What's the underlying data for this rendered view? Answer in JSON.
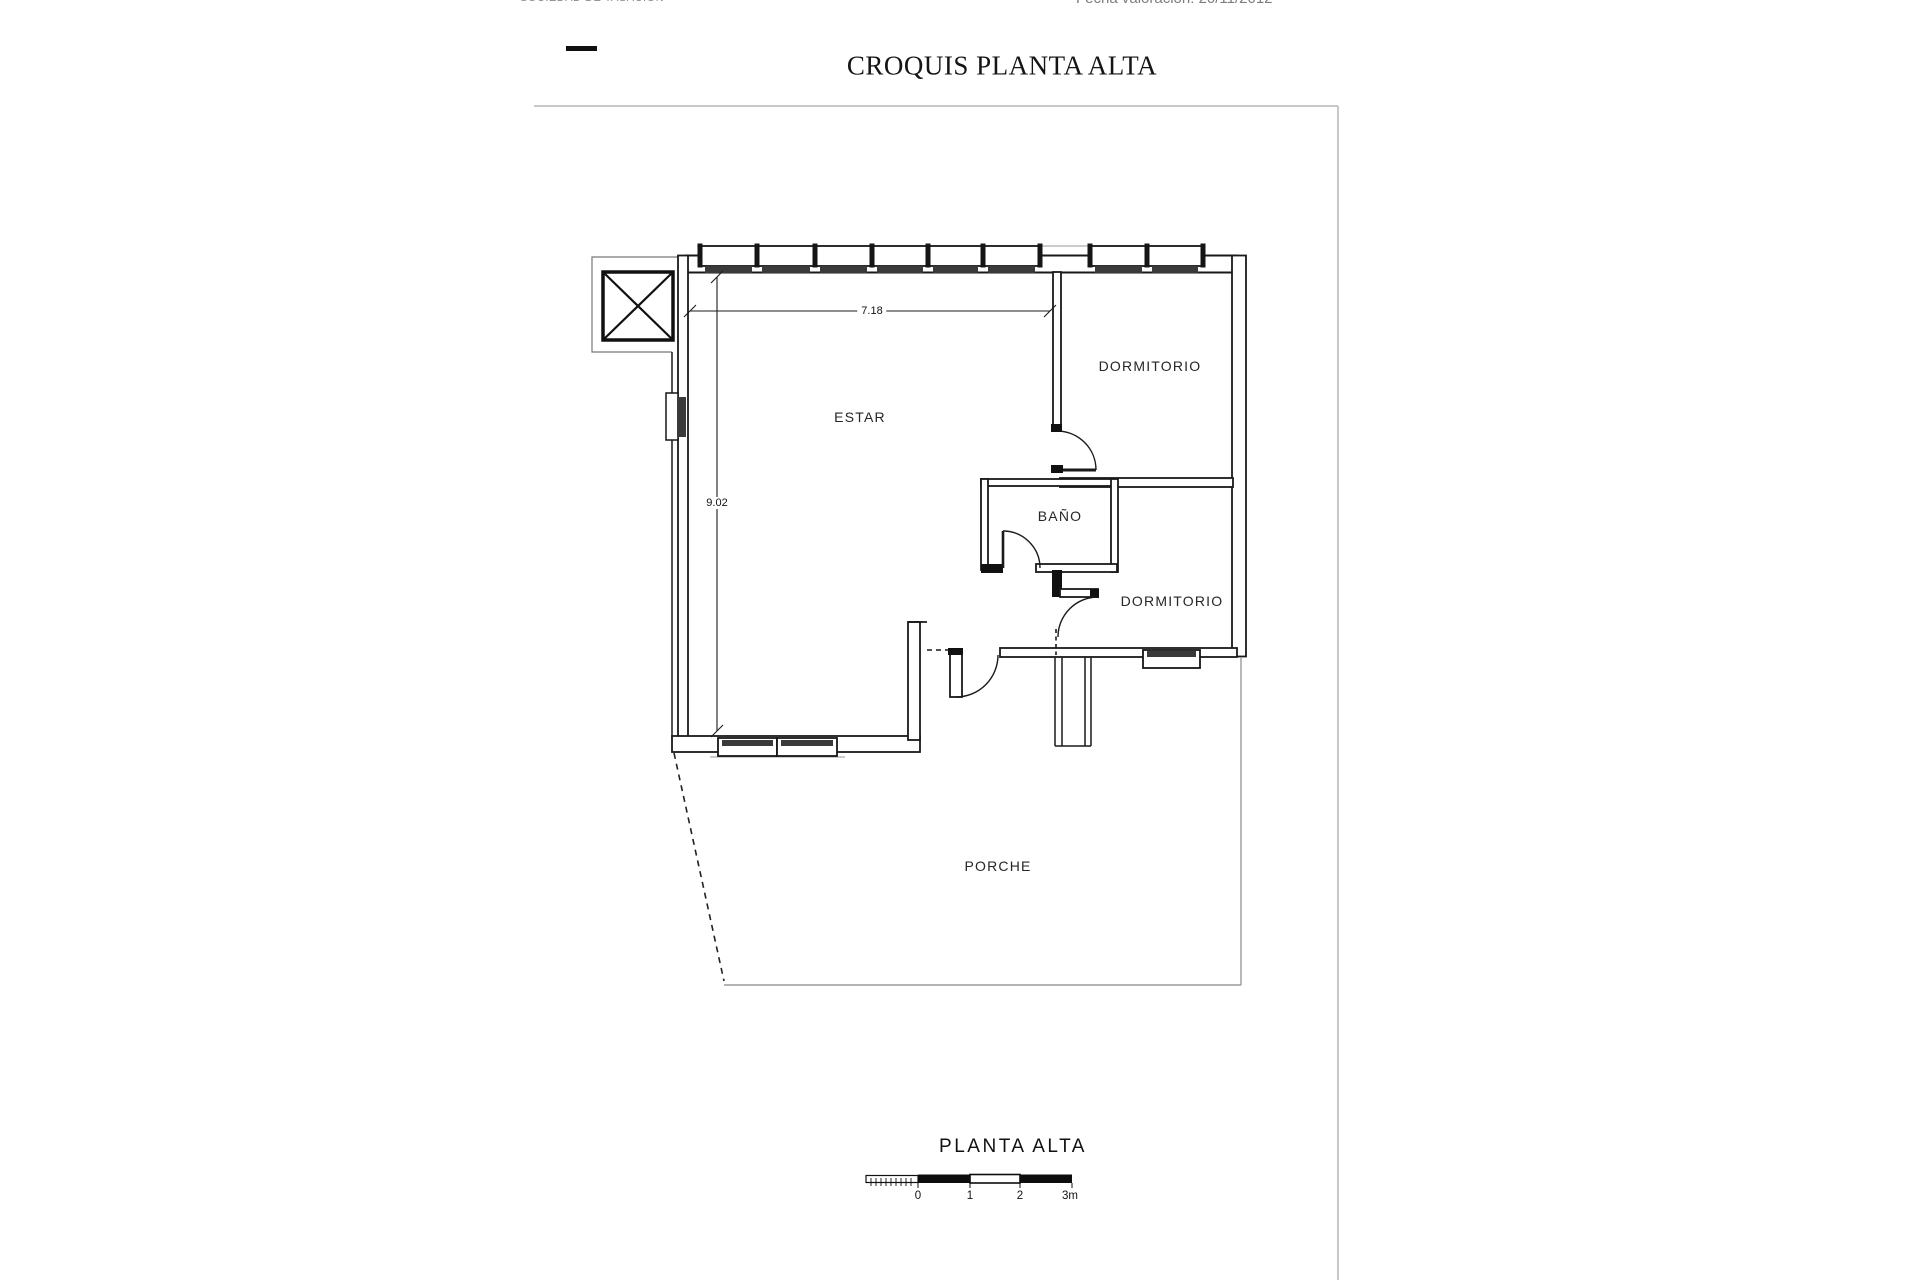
{
  "page": {
    "header_company": "SOCIEDAD DE TASACIÓN",
    "header_date": "Fecha valoración: 20/11/2012",
    "title": "CROQUIS PLANTA ALTA"
  },
  "plan": {
    "labels": {
      "estar": "ESTAR",
      "dormitorio_1": "DORMITORIO",
      "bano": "BAÑO",
      "dormitorio_2": "DORMITORIO",
      "porche": "PORCHE"
    },
    "dimensions": {
      "width_m": "7.18",
      "height_m": "9.02"
    }
  },
  "footer": {
    "caption": "PLANTA ALTA",
    "scale_labels": [
      "0",
      "1",
      "2",
      "3m"
    ]
  }
}
